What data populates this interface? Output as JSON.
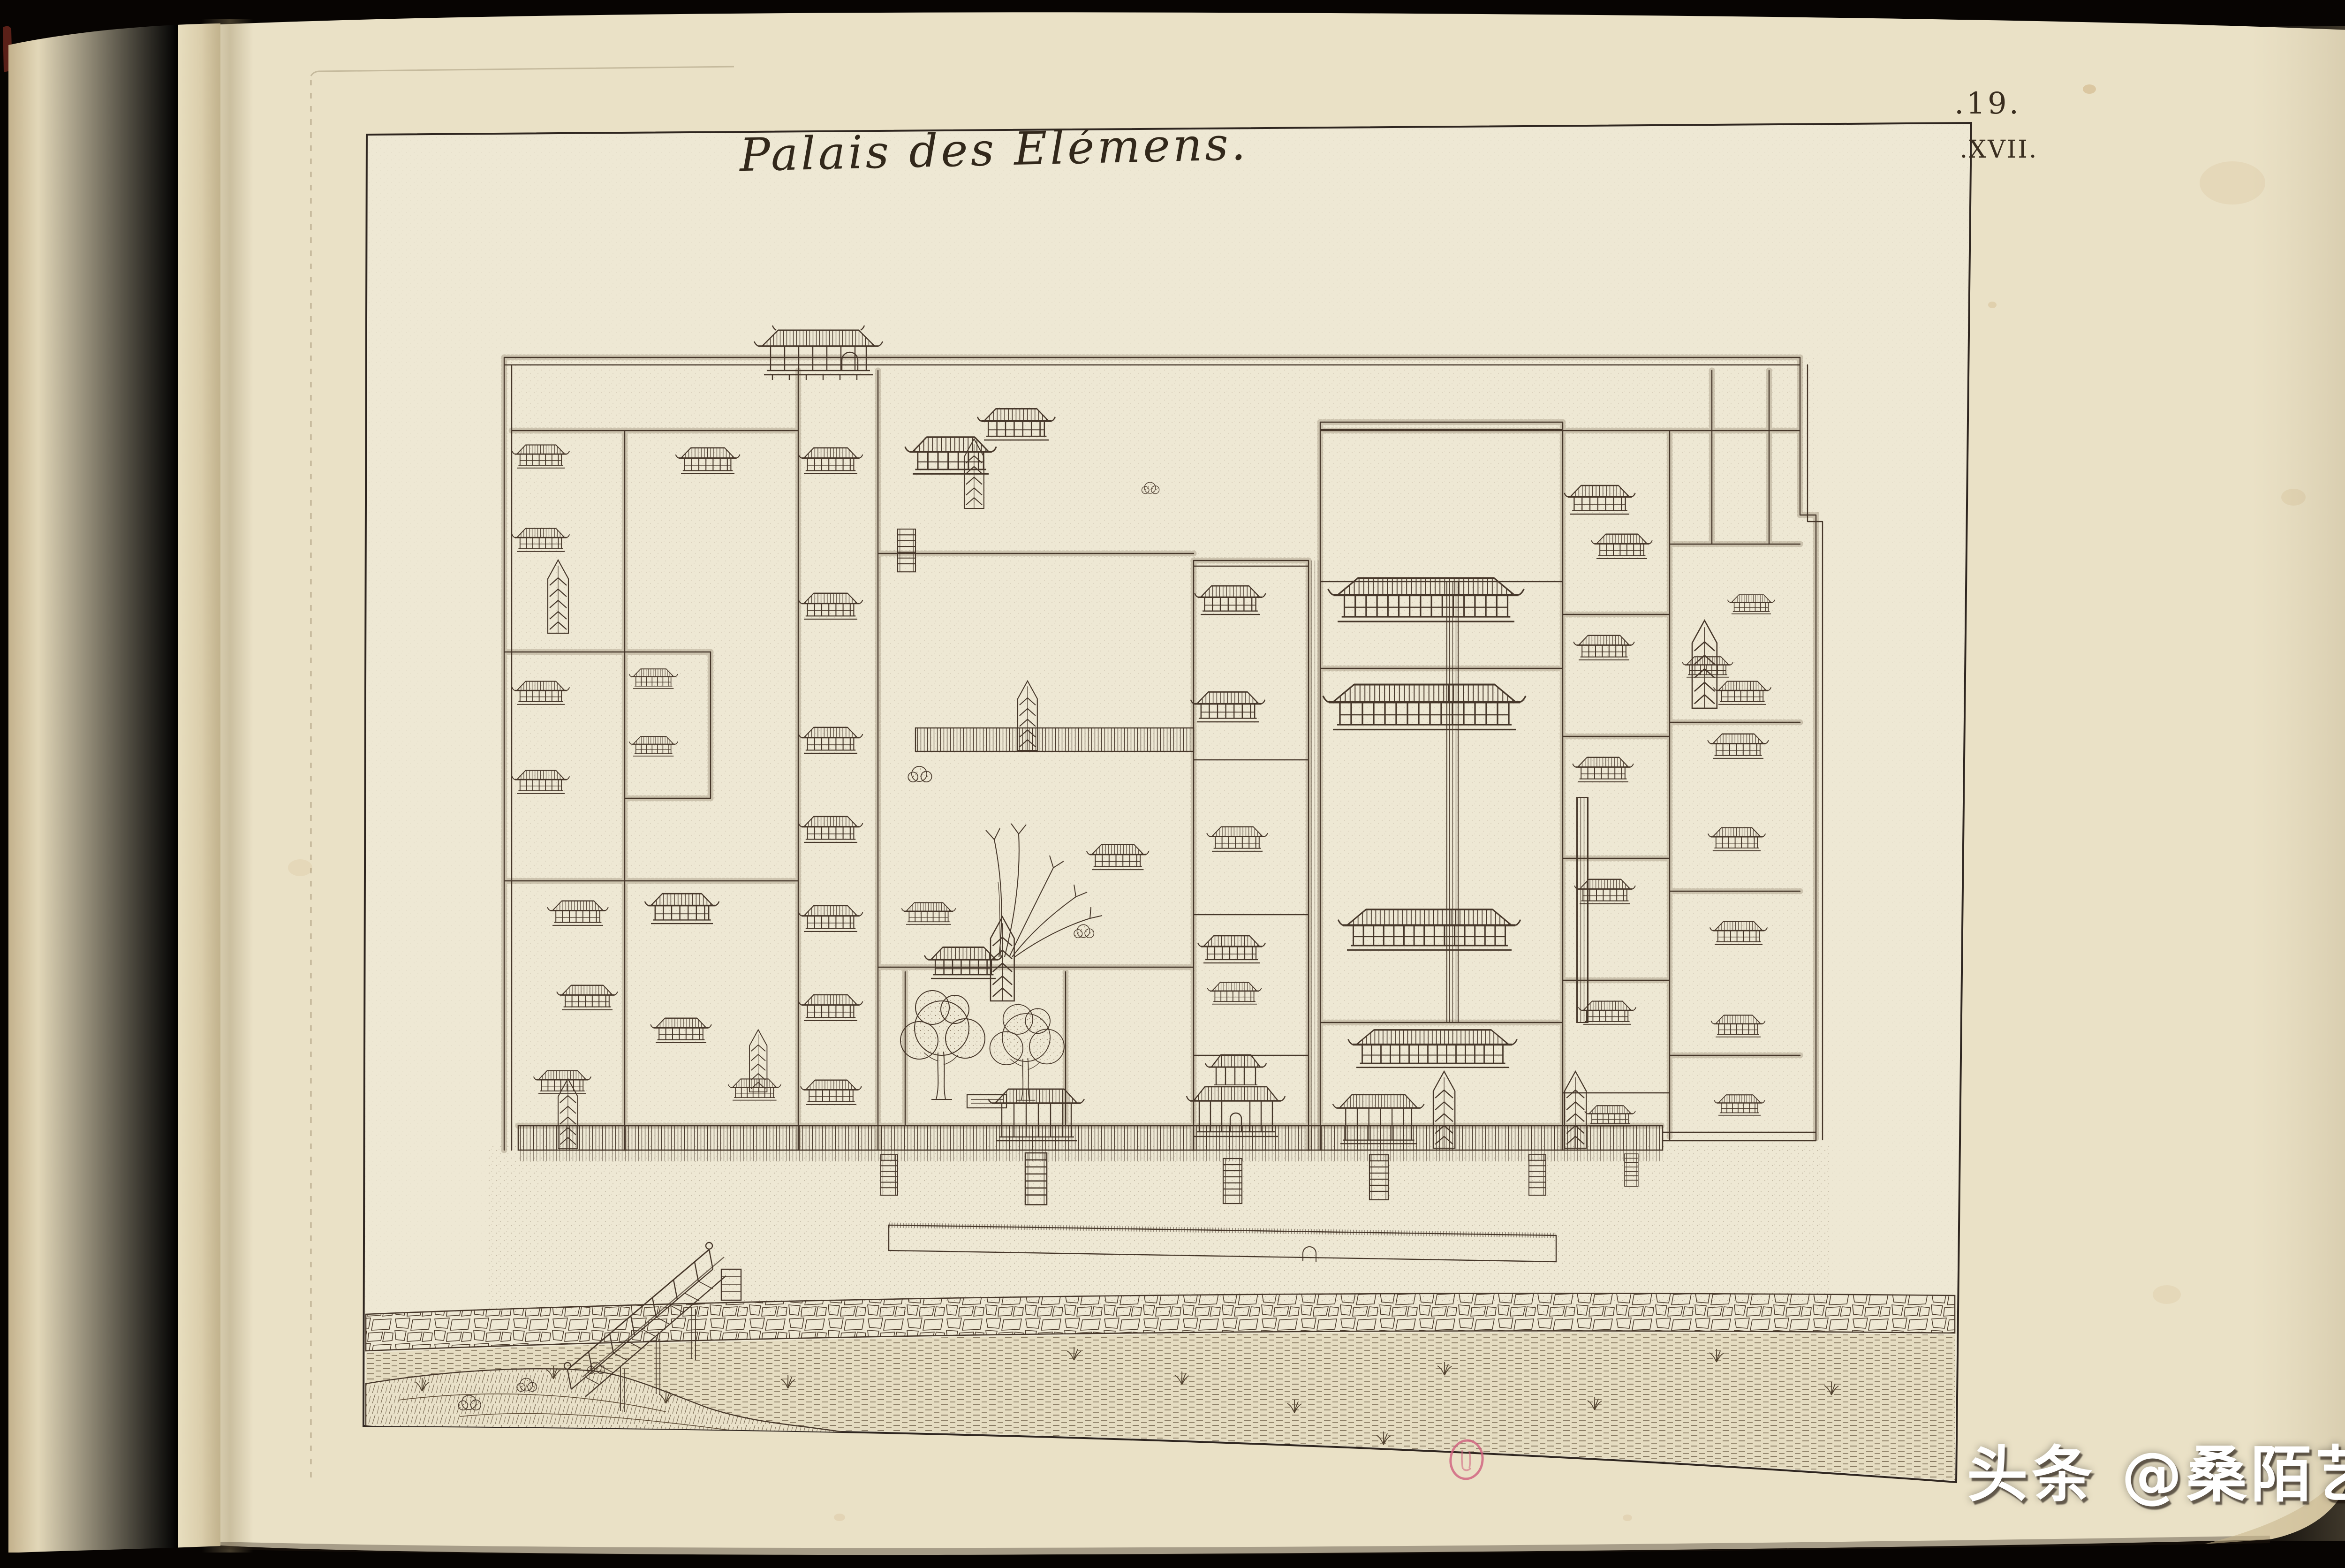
{
  "engraving": {
    "title": "Palais des Elémens.",
    "plate_number": ".19.",
    "plate_roman": ".XVII."
  },
  "stamp": {
    "color": "#cf5f7d"
  },
  "watermark": {
    "text": "头条 @桑陌艺术",
    "color": "#ffffff"
  },
  "colors": {
    "photo_background": "#070402",
    "left_page_paper": "#e7ddbf",
    "main_page_paper": "#eae1c6",
    "plate_paper": "#eee8d4",
    "engraving_ink": "#46372a",
    "marbling_base": "#b28a50",
    "marbling_yellow": "#d2ca66",
    "marbling_red": "#a93226",
    "marbling_blue": "#2e3f96",
    "stamp_pink": "#cf5f7d",
    "watermark_text": "#ffffff"
  }
}
